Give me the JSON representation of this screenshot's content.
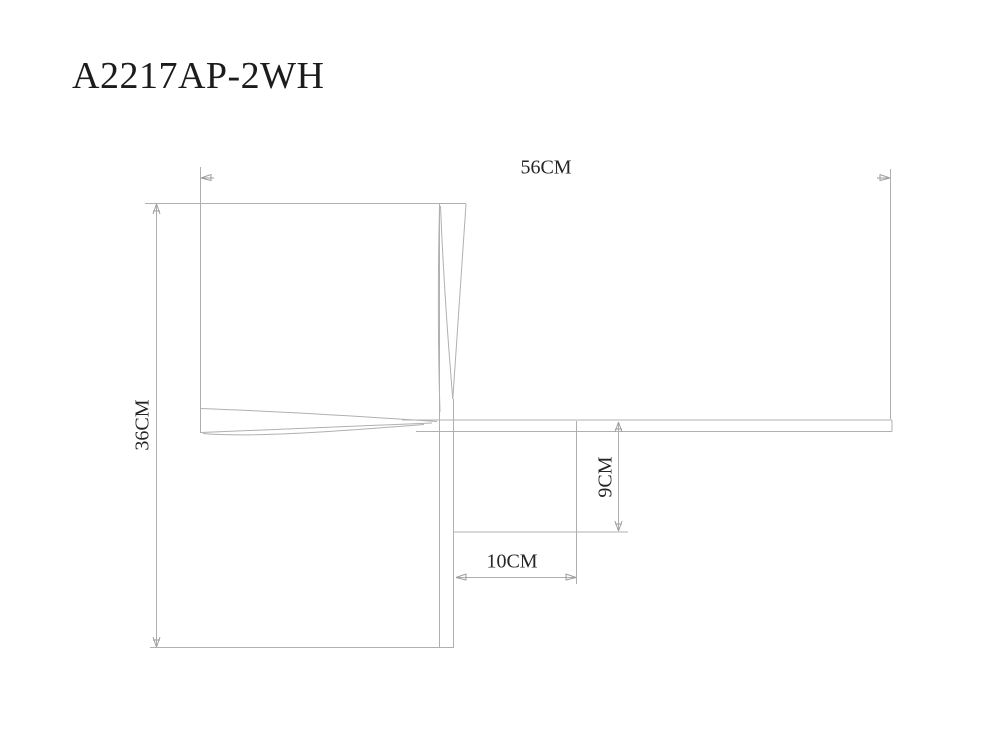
{
  "title": {
    "model": "A2217AP-2WH"
  },
  "drawing": {
    "type": "technical-dimension-drawing",
    "subject": "wall-lamp side profile with twisted blade arms",
    "line_color": "#b0b0b0",
    "arrow_color": "#9e9e9e",
    "text_color": "#262626",
    "background_color": "#ffffff",
    "dimensions": [
      {
        "id": "overall-width",
        "label": "56CM",
        "orientation": "horizontal"
      },
      {
        "id": "overall-height",
        "label": "36CM",
        "orientation": "vertical"
      },
      {
        "id": "bar-offset",
        "label": "9CM",
        "orientation": "vertical"
      },
      {
        "id": "plate-depth",
        "label": "10CM",
        "orientation": "horizontal"
      }
    ]
  }
}
